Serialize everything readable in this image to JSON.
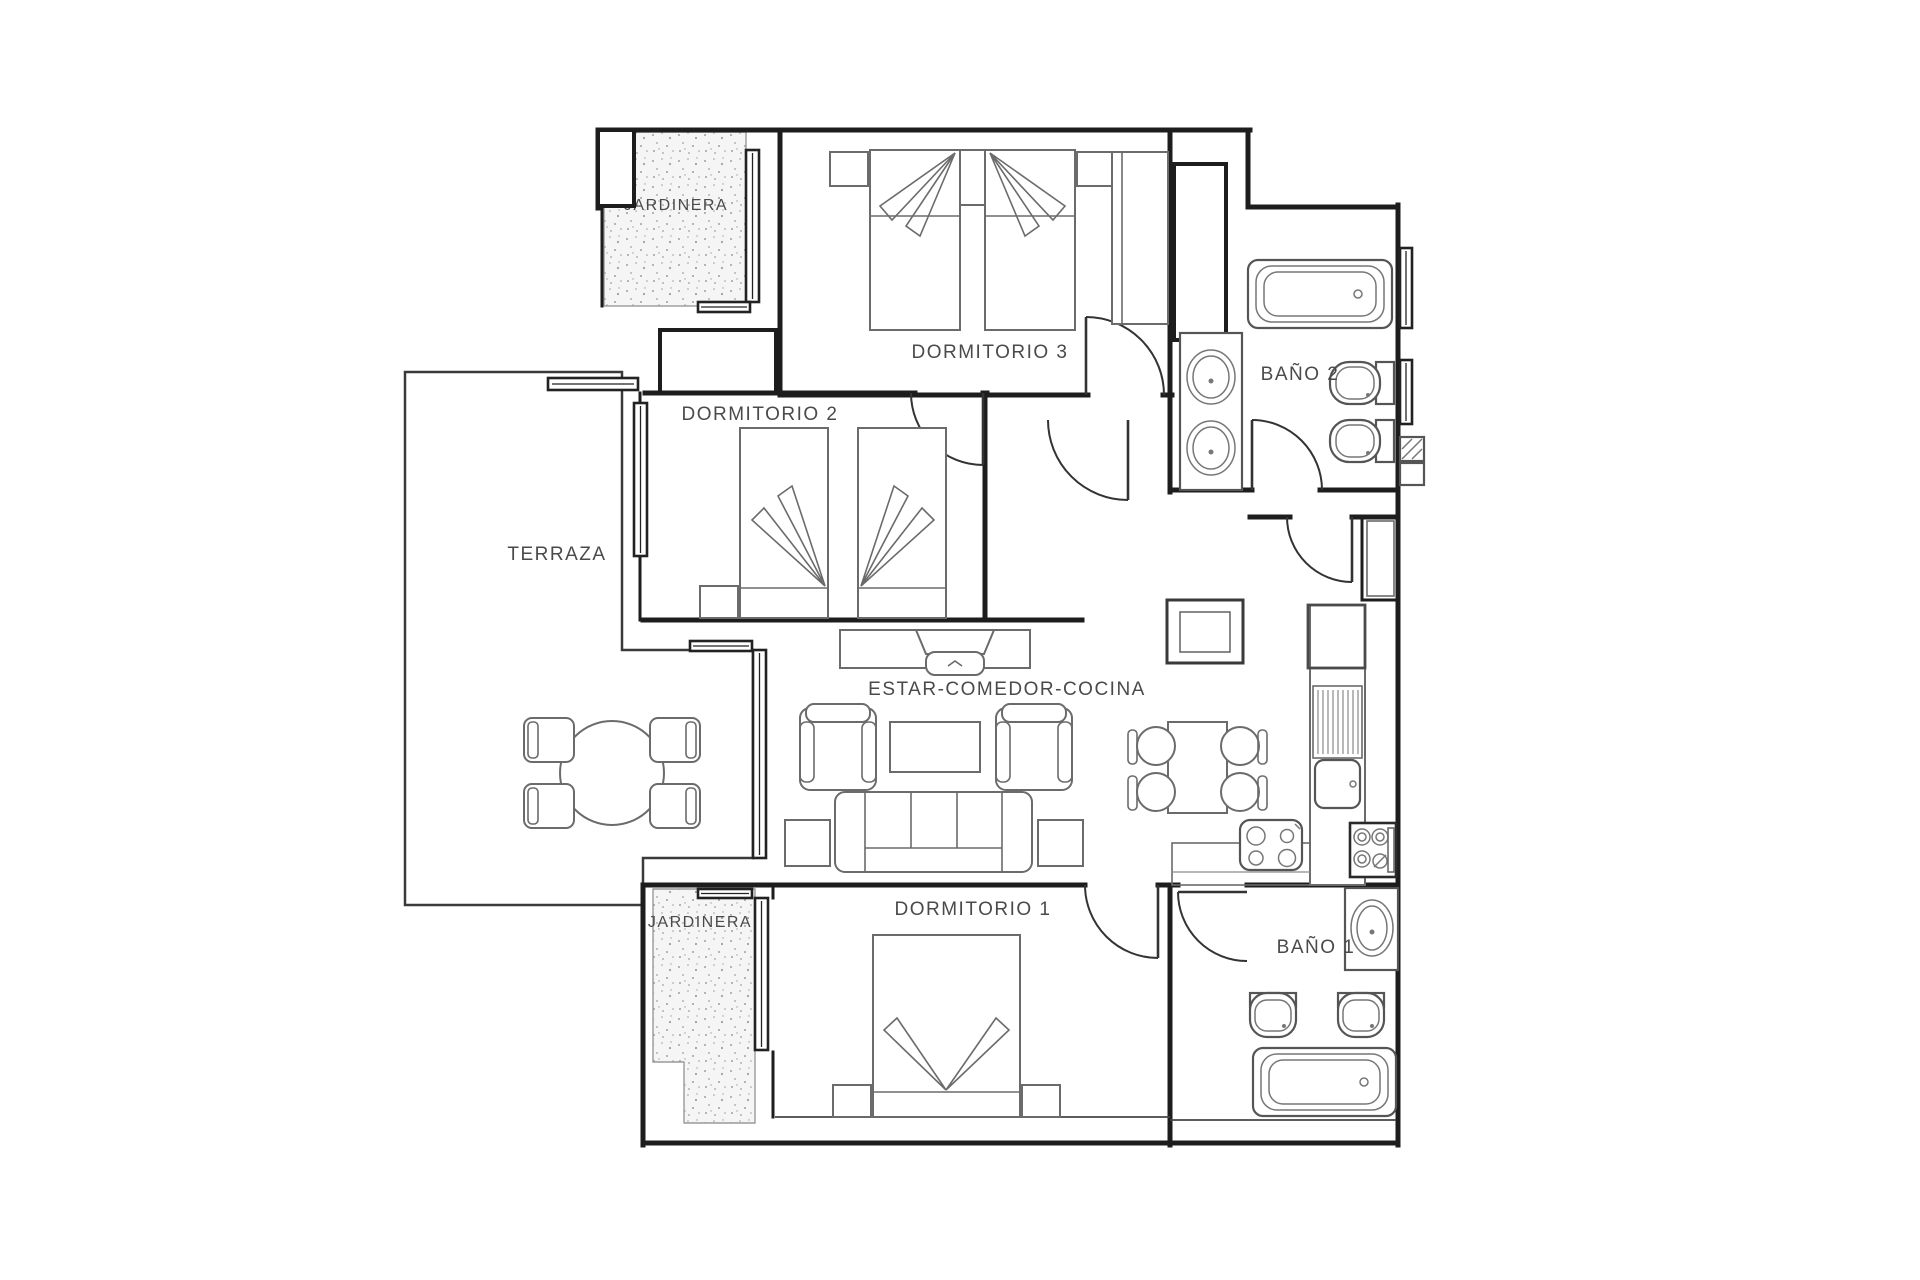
{
  "plan": {
    "type": "apartment-floor-plan",
    "rooms": {
      "jardinera_top": "JARDINERA",
      "dormitorio3": "DORMITORIO 3",
      "dormitorio2": "DORMITORIO 2",
      "bano2": "BAÑO 2",
      "terraza": "TERRAZA",
      "estar": "ESTAR-COMEDOR-COCINA",
      "dormitorio1": "DORMITORIO 1",
      "bano1": "BAÑO 1",
      "jardinera_bottom": "JARDINERA"
    },
    "colors": {
      "wall": "#1d1d1d",
      "furniture": "#6b6b6b",
      "label": "#4a4a4a",
      "brick": "#c8c8c8",
      "speckle": "#9f9f9f",
      "background": "#ffffff"
    }
  }
}
